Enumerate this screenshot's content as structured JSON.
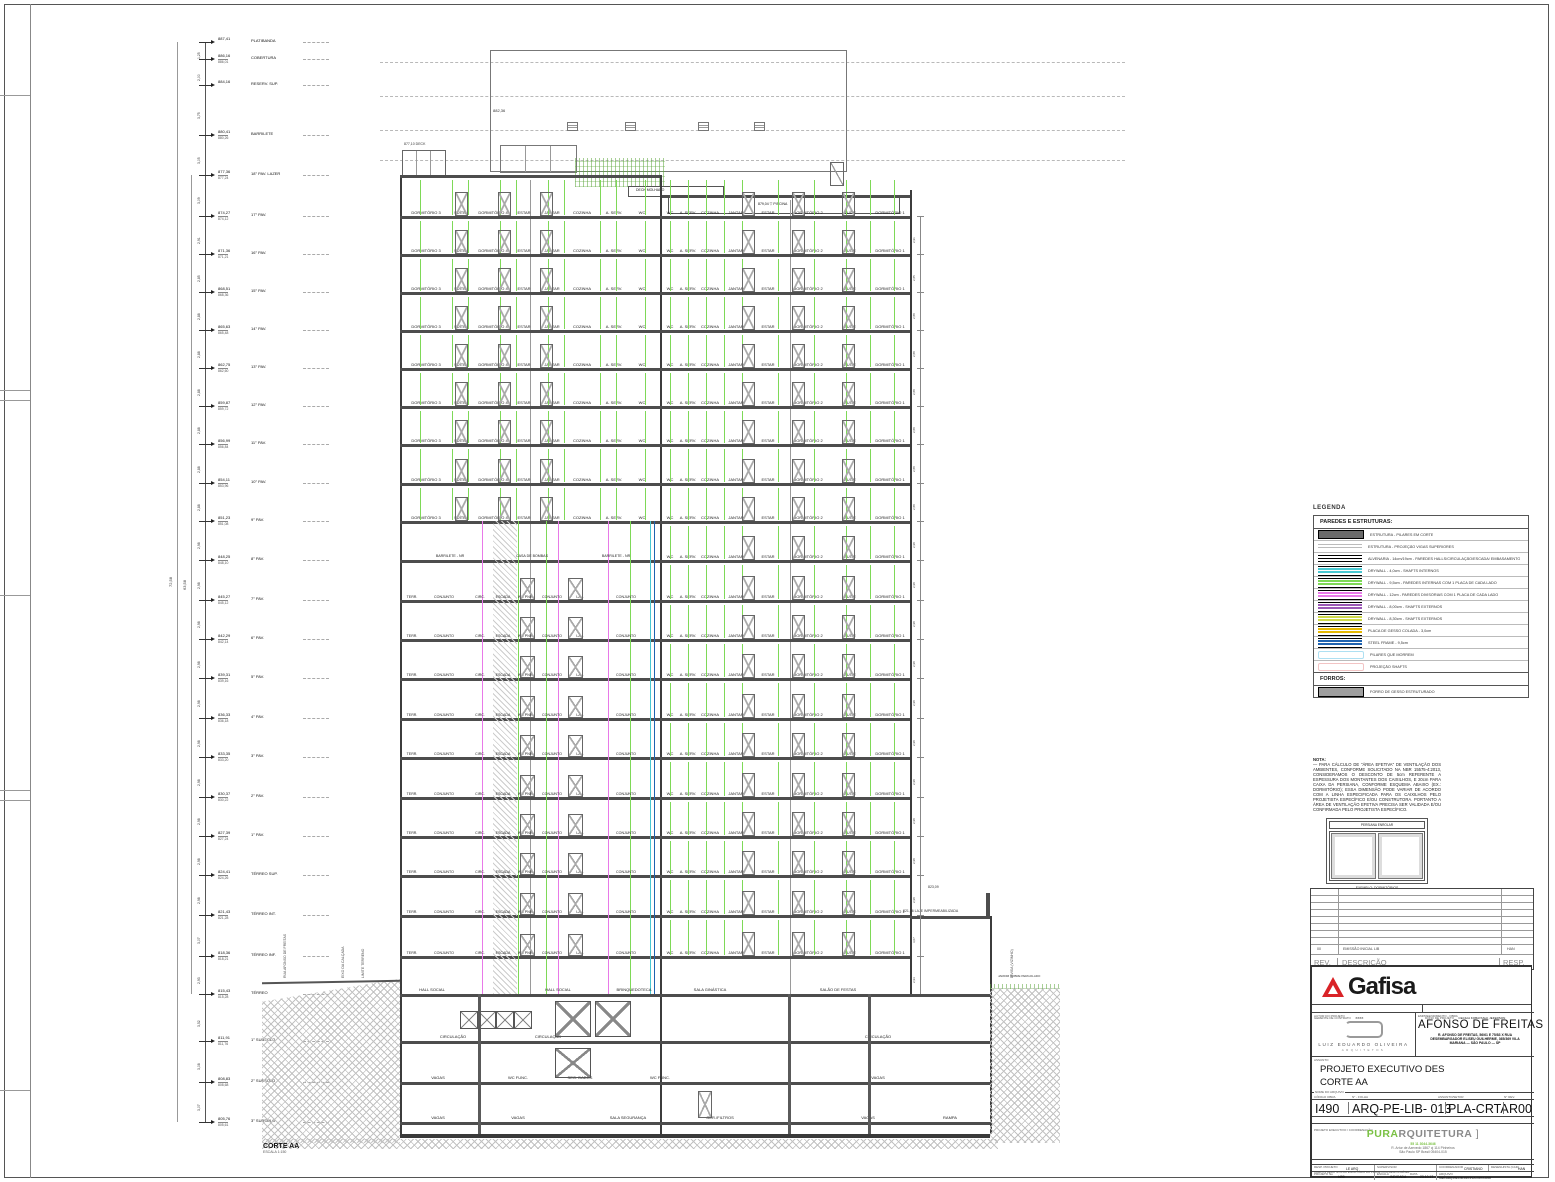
{
  "sheet": {
    "corte_label": "CORTE AA",
    "corte_scale": "ESCALA 1:150"
  },
  "ladder": {
    "overall_dim_1": "72,58",
    "overall_dim_2": "63,58",
    "levels": [
      {
        "elev": "887,41",
        "elev2": "",
        "label": "PLATIBANDA"
      },
      {
        "elev": "886,16",
        "elev2": "886,01",
        "label": "COBERTURA"
      },
      {
        "elev": "884,16",
        "elev2": "",
        "label": "RESERV. SUP."
      },
      {
        "elev": "880,41",
        "elev2": "880,26",
        "label": "BARRILETE"
      },
      {
        "elev": "877,36",
        "elev2": "877,24",
        "label": "18° PAV. LAZER"
      },
      {
        "elev": "874,27",
        "elev2": "874,12",
        "label": "17° PAV."
      },
      {
        "elev": "871,36",
        "elev2": "871,21",
        "label": "16° PAV."
      },
      {
        "elev": "868,51",
        "elev2": "868,36",
        "label": "15° PAV."
      },
      {
        "elev": "865,63",
        "elev2": "865,48",
        "label": "14° PAV."
      },
      {
        "elev": "862,75",
        "elev2": "862,60",
        "label": "13° PAV."
      },
      {
        "elev": "859,87",
        "elev2": "859,72",
        "label": "12° PAV."
      },
      {
        "elev": "856,99",
        "elev2": "856,84",
        "label": "11° PAV."
      },
      {
        "elev": "854,11",
        "elev2": "853,96",
        "label": "10° PAV."
      },
      {
        "elev": "851,23",
        "elev2": "851,08",
        "label": "9° PAV."
      },
      {
        "elev": "848,25",
        "elev2": "848,10",
        "label": "8° PAV."
      },
      {
        "elev": "845,27",
        "elev2": "845,12",
        "label": "7° PAV."
      },
      {
        "elev": "842,29",
        "elev2": "842,14",
        "label": "6° PAV."
      },
      {
        "elev": "839,31",
        "elev2": "839,16",
        "label": "5° PAV."
      },
      {
        "elev": "836,33",
        "elev2": "836,18",
        "label": "4° PAV."
      },
      {
        "elev": "833,35",
        "elev2": "833,20",
        "label": "3° PAV."
      },
      {
        "elev": "830,37",
        "elev2": "830,22",
        "label": "2° PAV."
      },
      {
        "elev": "827,39",
        "elev2": "827,24",
        "label": "1° PAV."
      },
      {
        "elev": "824,41",
        "elev2": "824,26",
        "label": "TÉRREO SUP."
      },
      {
        "elev": "821,43",
        "elev2": "821,28",
        "label": "TÉRREO INT."
      },
      {
        "elev": "818,36",
        "elev2": "818,21",
        "label": "TÉRREO INF."
      },
      {
        "elev": "815,43",
        "elev2": "815,28",
        "label": "TÉRREO"
      },
      {
        "elev": "811,91",
        "elev2": "811,76",
        "label": "1° SUBSOLO"
      },
      {
        "elev": "808,83",
        "elev2": "808,68",
        "label": "2° SUBSOLO"
      },
      {
        "elev": "805,76",
        "elev2": "805,61",
        "label": "3° SUBSOLO"
      }
    ]
  },
  "building": {
    "deck_label": "DECK MOLHADO",
    "pool_label": "PISCINA",
    "pool_elev": "879,04",
    "roof_elev": "882,36",
    "deck_left_elev": "877,10",
    "deck_left_label": "DECK",
    "residential_left": [
      "DORMITÓRIO 3",
      "SUÍTE",
      "DORMITÓRIO 4",
      "ESTAR",
      "JANTAR",
      "COZINHA",
      "A. SERV.",
      "WC"
    ],
    "residential_right": [
      "WC",
      "A. SERV.",
      "COZINHA",
      "JANTAR",
      "ESTAR",
      "DORMITÓRIO 2",
      "SUÍTE",
      "DORMITÓRIO 1"
    ],
    "office_left": [
      "TERR.",
      "CONJUNTO",
      "CIRC.",
      "ESCADA",
      "WC PNE",
      "CONJUNTO",
      "LAV.",
      "CONJUNTO"
    ],
    "barrilete_labels": [
      "BARRILETE - NR",
      "CASA DE BOMBAS",
      "BARRILETE - NR"
    ],
    "ground_labels": [
      "HALL SOCIAL",
      "HALL SOCIAL",
      "BRINQUEDOTECA",
      "SALA GINÁSTICA",
      "SALÃO DE FESTAS"
    ],
    "basement_labels": [
      [
        "CIRCULAÇÃO",
        "CIRCULAÇÃO",
        "CIRCULAÇÃO"
      ],
      [
        "VAGAS",
        "WC FUNC.",
        "SEG. DADOS",
        "WC FUNC.",
        "VAGAS"
      ],
      [
        "VAGAS",
        "VAGAS",
        "SALA SEGURANÇA",
        "GER./FILTROS",
        "VAGAS",
        "RAMPA"
      ]
    ],
    "annex": {
      "elev_top": "823,09",
      "elev_slab": "821,36",
      "slab_label": "LAJE IMPERMEABILIZADA",
      "garden_label": "JARDIM SOBRE PERGOLADO"
    },
    "site_labels_left": [
      "RUA AFONSO DE FREITAS",
      "EIXO DA CALÇADA",
      "LIMITE TERRENO"
    ],
    "site_label_right": "DIVISA (VIZINHO)"
  },
  "legend": {
    "title": "LEGENDA",
    "section1": "PAREDES E ESTRUTURAS:",
    "rows": [
      {
        "type": "pilar",
        "color": "#6a6a6a",
        "text": "ESTRUTURA - PILARES EM CORTE"
      },
      {
        "type": "vigas",
        "color": "#bbbbbb",
        "text": "ESTRUTURA - PROJEÇÃO VIGAS SUPERIORES"
      },
      {
        "type": "alvenaria",
        "color": "#000000",
        "text": "ALVENARIA - 14cm/19cm - PAREDES HALLS/CIRCULAÇÃO/ESCADA/ EMBASAMENTO"
      },
      {
        "type": "lines",
        "color": "#49c8d2",
        "text": "DRYWALL - 4,0cm - SHAFTS INTERNOS"
      },
      {
        "type": "lines",
        "color": "#7ed957",
        "text": "DRYWALL - 9,5cm - PAREDES INTERNAS COM 1 PLACA DE CADA LADO"
      },
      {
        "type": "lines",
        "color": "#e879e8",
        "text": "DRYWALL - 12cm - PAREDES DIVISÓRIAS COM 1 PLACA DE CADA LADO"
      },
      {
        "type": "lines",
        "color": "#9b59b6",
        "text": "DRYWALL - 8,00cm - SHAFTS EXTERNOS"
      },
      {
        "type": "lines",
        "color": "#cdd94a",
        "text": "DRYWALL - 8,30cm - SHAFTS EXTERNOS"
      },
      {
        "type": "lines",
        "color": "#e6b800",
        "text": "PLACA DE GESSO COLADA - 3,0cm"
      },
      {
        "type": "lines",
        "color": "#1f63b0",
        "text": "STEEL FRAME - 9,5cm"
      },
      {
        "type": "outline",
        "color": "#aee0f2",
        "text": "PILARES QUE MORREM"
      },
      {
        "type": "outline",
        "color": "#f2c4c4",
        "text": "PROJEÇÃO SHAFTS"
      }
    ],
    "section2": "FORROS:",
    "rows2": [
      {
        "type": "fill",
        "color": "#9e9e9e",
        "text": "FORRO DE GESSO ESTRUTURADO"
      }
    ]
  },
  "nota": {
    "title": "NOTA:",
    "body": "— PARA CÁLCULO DE \"ÁREA EFETIVA\" DE VENTILAÇÃO DOS AMBIENTES, CONFORME SOLICITADO NA NBR 15575-4:2013, CONSIDERAMOS O DESCONTO DE 5cm REFERENTE A ESPESSURA DOS MONTANTES DOS CAIXILHOS, E 20cm PARA CAIXA DA PERSIANA, CONFORME ESQUEMA ABAIXO (EX.: DORMITÓRIO); ESSA DIMENSÃO PODE VARIAR DE ACORDO COM A LINHA ESPECIFICADA PARA OS CAIXILHOS PELO PROJETISTA ESPECÍFICO E/OU CONSTRUTORA. PORTANTO A ÁREA DE VENTILAÇÃO EFETIVA PRECISA SER VALIDADA E/OU CONFIRMADA PELO PROJETISTA ESPECÍFICO.",
    "diagram_header": "PERSIANA ENROLAR",
    "diagram_caption": "EXEMPLO: DORMITÓRIOS"
  },
  "rev_table": {
    "row00": {
      "rev": "00",
      "desc": "EMISSÃO INICIAL LIB",
      "resp": "HAN"
    },
    "header": {
      "rev": "REV.",
      "desc": "DESCRIÇÃO",
      "resp": "RESP."
    }
  },
  "title_block": {
    "brand": "Gafisa",
    "gerente_label": "GERENTE DE CONTRATO",
    "gerente_value": "XXXX",
    "dono_label": "DONO DE PROJETO",
    "dono_value": "CECILIA KOBAYASHI, JEFERSON",
    "autor_label": "AUTOR DO PROJETO",
    "autor_name": "LUIZ EDUARDO OLIVEIRA",
    "autor_sub": "ARQUITETOS",
    "empreendimento_label": "EMPREENDIMENTO - OBRA",
    "empreendimento_name": "AFONSO DE FREITAS",
    "empreendimento_addr1": "R. AFONSO DE FREITAS, 56/61 E 75/83 X RUA",
    "empreendimento_addr2": "DESEMBARGADOR ELISEU GUILHERME, 365/369 VILA",
    "empreendimento_addr3": "MARIANA — SÃO PAULO — SP",
    "assunto_label": "ASSUNTO",
    "assunto_line1": "PROJETO EXECUTIVO DES",
    "assunto_line2": "CORTE AA",
    "nome_arquivo_label": "NOME DO ARQUIVO",
    "codigo_obra_label": "CÓDIGO OBRA",
    "folha_label": "N° - FOLHA",
    "setor_label": "ASSUNTO/SETOR",
    "rev_label": "N° REV.",
    "codigo_obra": "I490",
    "folha": "ARQ-PE-LIB- 013",
    "setor": "PLA-CRTA",
    "rev": "R00",
    "coord_label": "PROJETO EXECUTIVO / COORDENAÇÃO",
    "pura_green": "PURA",
    "pura_gray": "RQUITETURA",
    "pura_phone": "55 11 3044.3646",
    "pura_addr1": "R. Artur de Azevedo 1867 cj 114 Pinheiros",
    "pura_addr2": "São Paulo SP Brasil 05404-015",
    "campos_label": "CAMPOS RELATIVOS AO ESCRITÓRIO DO PROJETISTA RESPONSÁVEL",
    "resp_projeto_label": "RESP. PROJETO",
    "resp_projeto": "LE ARQ",
    "supervisor_label": "SUPERVISOR",
    "supervisor": "",
    "coordenador_label": "COORDENADOR",
    "coordenador": "CRISTIANO",
    "desenhista_label": "DESENHISTA (CAD)",
    "desenhista": "HAN",
    "projeto_no_label": "PROJETO No",
    "projeto_no": "I490",
    "escala_label": "ESCALA",
    "escala": "INDICADA",
    "data_label": "DATA",
    "data": "23.10.17",
    "arquivo_label": "ARQUIVO",
    "arquivo": "I490-ARQ-PE-LIB-013-PLA-CRTA-R00"
  }
}
